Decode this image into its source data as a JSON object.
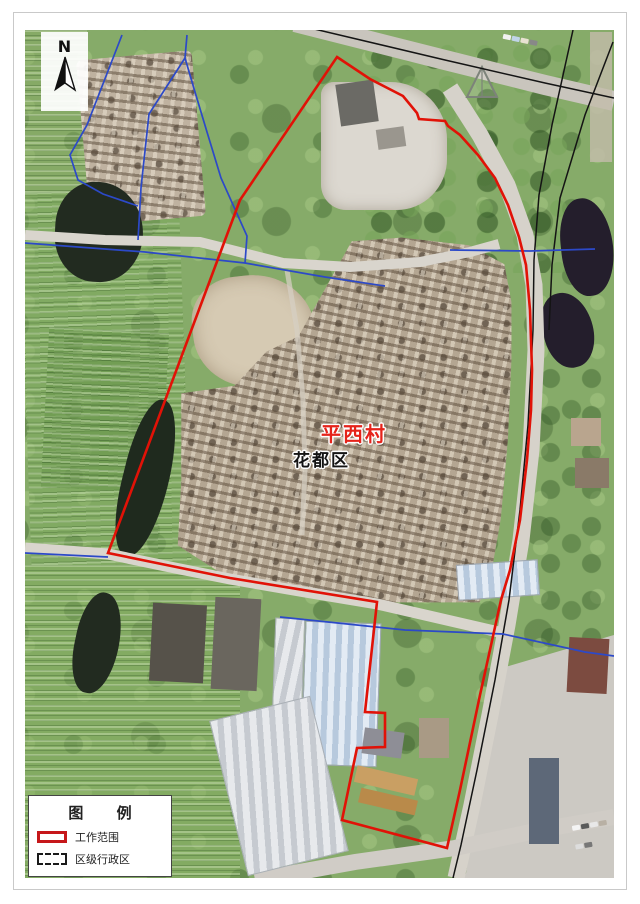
{
  "map": {
    "labels": {
      "village": "平西村",
      "district": "花都区"
    },
    "north_label": "N",
    "legend": {
      "title": "图 例",
      "items": [
        {
          "label": "工作范围"
        },
        {
          "label": "区级行政区"
        }
      ]
    },
    "colors": {
      "boundary_red": "#e11207",
      "admin_blue": "#2c49c8",
      "road_black": "#141414",
      "village_label_red": "#e5231a",
      "district_label_black": "#141414",
      "legend_swatch_red": "#c6171a"
    }
  }
}
